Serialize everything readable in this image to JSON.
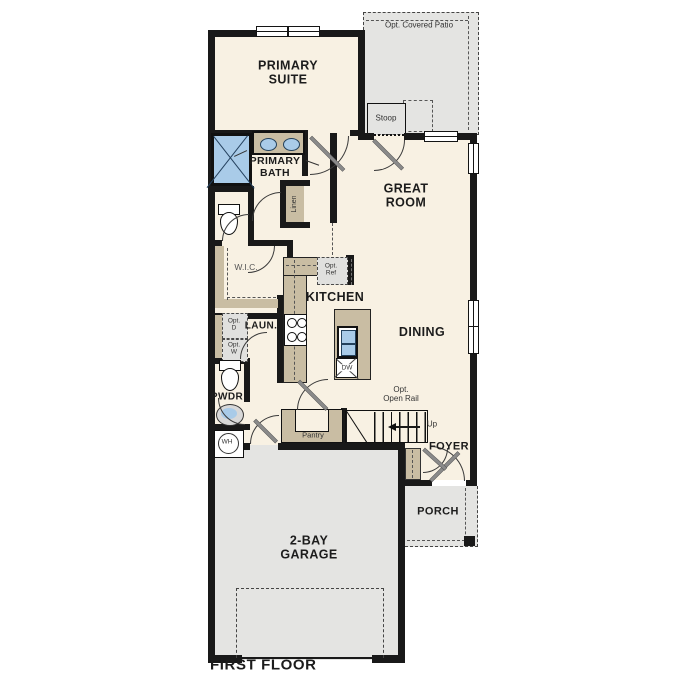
{
  "plan_title": "FIRST FLOOR",
  "rooms": {
    "primary_suite": "PRIMARY\nSUITE",
    "primary_bath": "PRIMARY\nBATH",
    "great_room": "GREAT\nROOM",
    "kitchen": "KITCHEN",
    "dining": "DINING",
    "wic": "W.I.C.",
    "linen": "Linen",
    "laundry": "LAUN.",
    "powder": "PWDR",
    "pantry": "Pantry",
    "foyer": "FOYER",
    "porch": "PORCH",
    "garage": "2-BAY\nGARAGE",
    "stoop": "Stoop",
    "covered_patio": "Opt. Covered Patio"
  },
  "fixtures": {
    "dishwasher": "DW",
    "water_heater": "WH",
    "opt_fridge": "Opt.\nRef",
    "opt_dryer": "Opt.\nD",
    "opt_washer": "Opt.\nW"
  },
  "stairs": {
    "direction": "Up",
    "opt_open_rail": "Opt.\nOpen Rail"
  },
  "colors": {
    "floor": "#f8f1e3",
    "garage_floor": "#e4e4e2",
    "cabinetry": "#c9bda3",
    "plumbing_blue": "#a9cbe8",
    "walls": "#191919",
    "optional_fill": "#e0e0de"
  }
}
